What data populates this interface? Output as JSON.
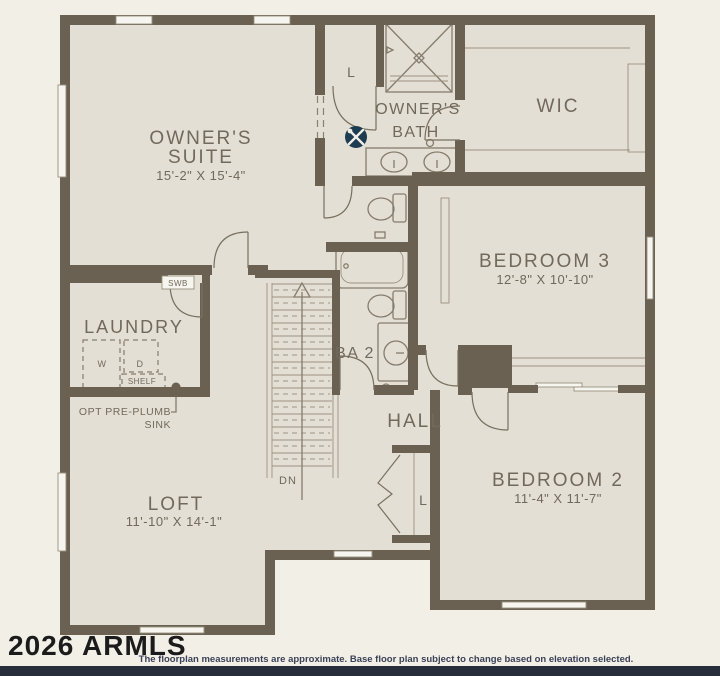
{
  "rooms": {
    "owners_suite": {
      "line1": "OWNER'S",
      "line2": "SUITE",
      "dims": "15'-2\" X 15'-4\""
    },
    "owners_bath": {
      "line1": "OWNER'S",
      "line2": "BATH"
    },
    "wic": {
      "label": "WIC"
    },
    "bedroom3": {
      "label": "BEDROOM 3",
      "dims": "12'-8\" X 10'-10\""
    },
    "bedroom2": {
      "label": "BEDROOM 2",
      "dims": "11'-4\" X 11'-7\""
    },
    "ba2": {
      "label": "BA 2"
    },
    "hall": {
      "label": "HALL"
    },
    "laundry": {
      "label": "LAUNDRY"
    },
    "loft": {
      "label": "LOFT",
      "dims": "11'-10\" X 14'-1\""
    }
  },
  "annotations": {
    "linen_upper": "L",
    "linen_hall": "L",
    "swb": "SWB",
    "washer": "W",
    "dryer": "D",
    "shelf": "SHELF",
    "opt_preplumb_line1": "OPT PRE-PLUMB",
    "opt_preplumb_line2": "SINK",
    "stairs_down": "DN"
  },
  "icons": {
    "customization_tools": "hammer-and-wrench-badge"
  },
  "colors": {
    "background": "#f2efe7",
    "floor": "#e4dfd4",
    "wall": "#6b6152",
    "fixture_line": "#857c6d",
    "label_text": "#70695c",
    "icon_badge": "#1d3c52",
    "footer_bar": "#272d3a"
  },
  "footer": {
    "watermark": "2026 ARMLS",
    "disclaimer": "The floorplan measurements are approximate. Base floor plan subject to change based on elevation selected."
  }
}
